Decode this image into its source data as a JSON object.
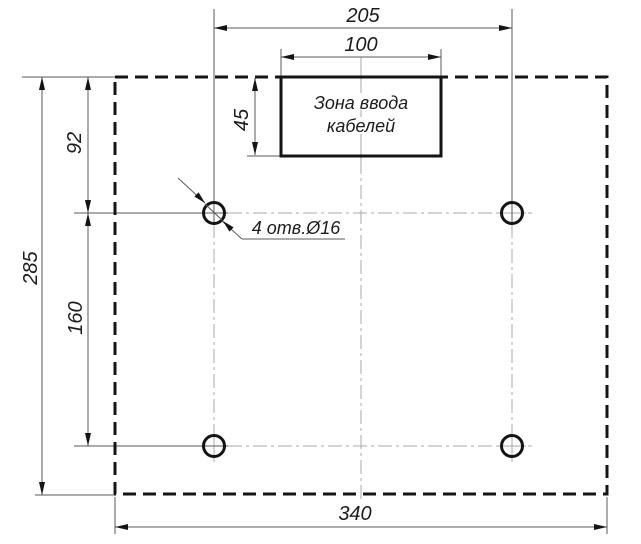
{
  "dimensions": {
    "hole_span_horizontal": "205",
    "cable_zone_width": "100",
    "cable_zone_height": "45",
    "top_edge_to_hole_row": "92",
    "hole_row_spacing": "160",
    "plate_height": "285",
    "plate_width": "340"
  },
  "annotations": {
    "holes_callout": "4 отв.Ø16",
    "cable_zone_line1": "Зона ввода",
    "cable_zone_line2": "кабелей"
  },
  "colors": {
    "background": "#ffffff",
    "bold_line": "#141414",
    "dimension_line": "#5a5a5a",
    "centerline": "#a8a8a8",
    "text": "#1c1c1c"
  }
}
